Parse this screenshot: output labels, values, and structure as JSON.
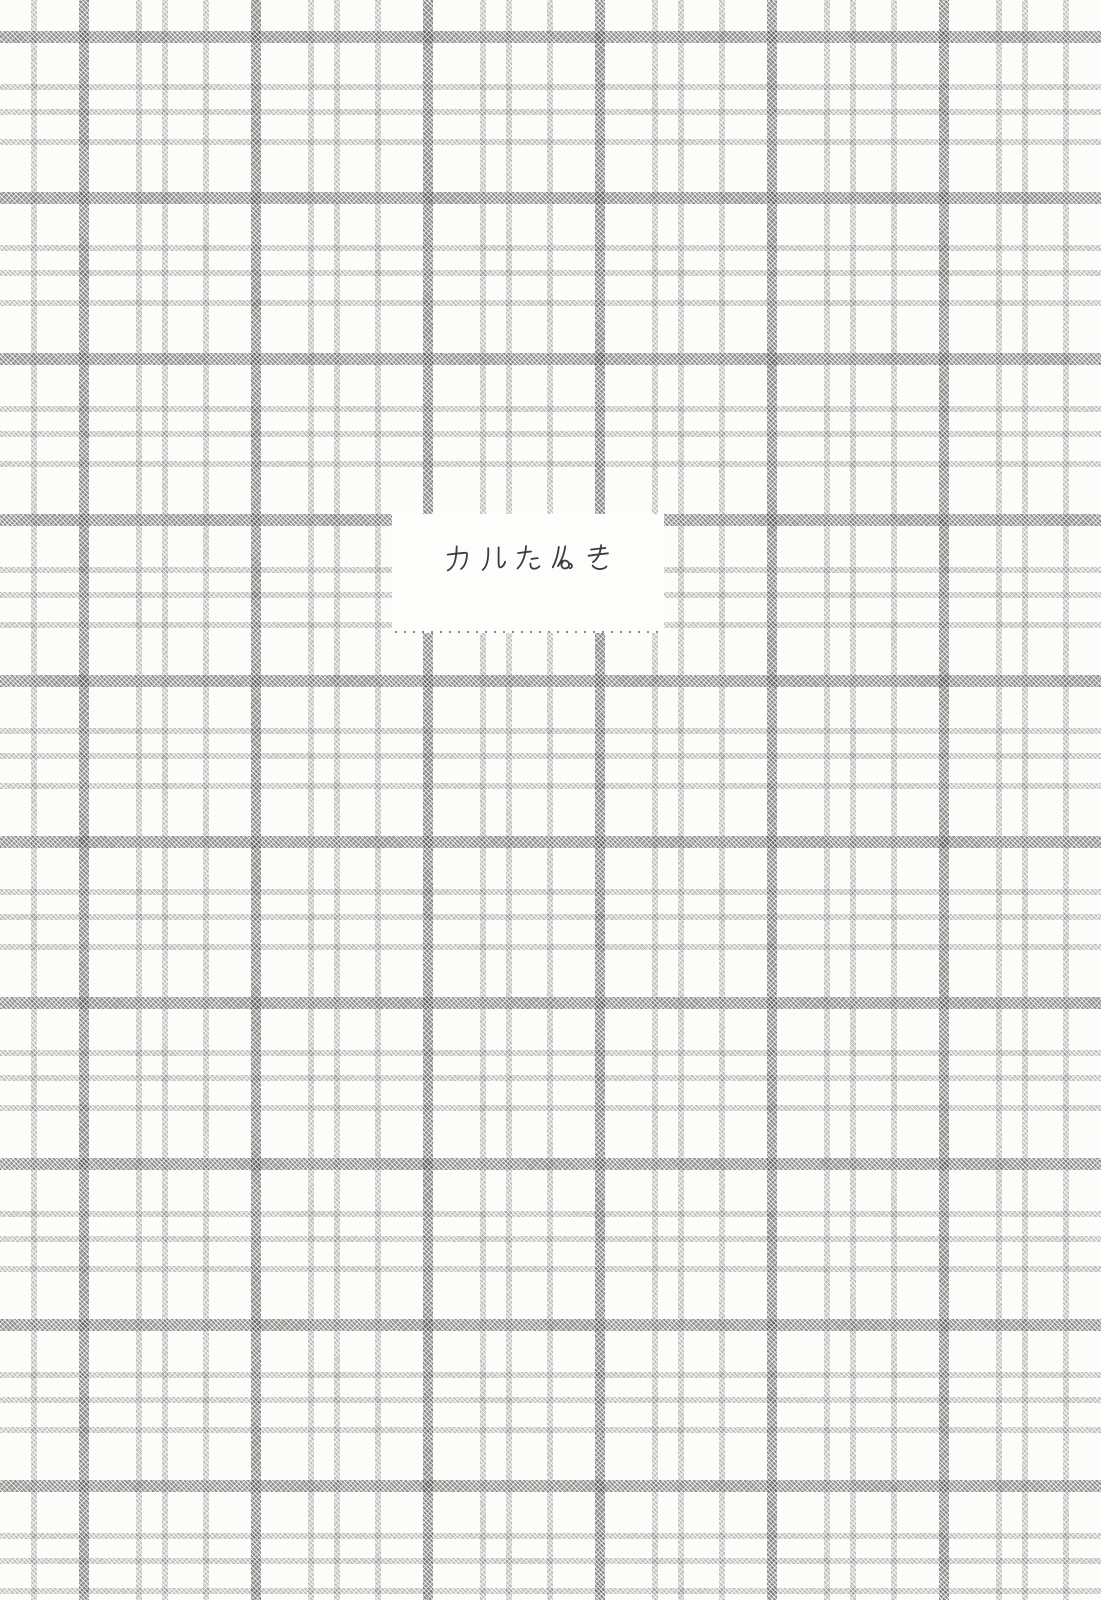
{
  "page": {
    "description": "Scanned book page with gray tartan plaid pattern and a white title label"
  },
  "label": {
    "title": "カルたぬき",
    "title_chars": [
      "カ",
      "ル",
      "た",
      "ぬ",
      "き"
    ],
    "bottom_edge": "dotted"
  },
  "colors": {
    "page-background": "#fbfbf8",
    "plaid-dark": "#8f8f8f",
    "plaid-light": "#b4b4b4",
    "label-background": "#fdfdfc",
    "label-dotted-border": "#8c8c8c",
    "title-ink": "#3c3c3c"
  }
}
